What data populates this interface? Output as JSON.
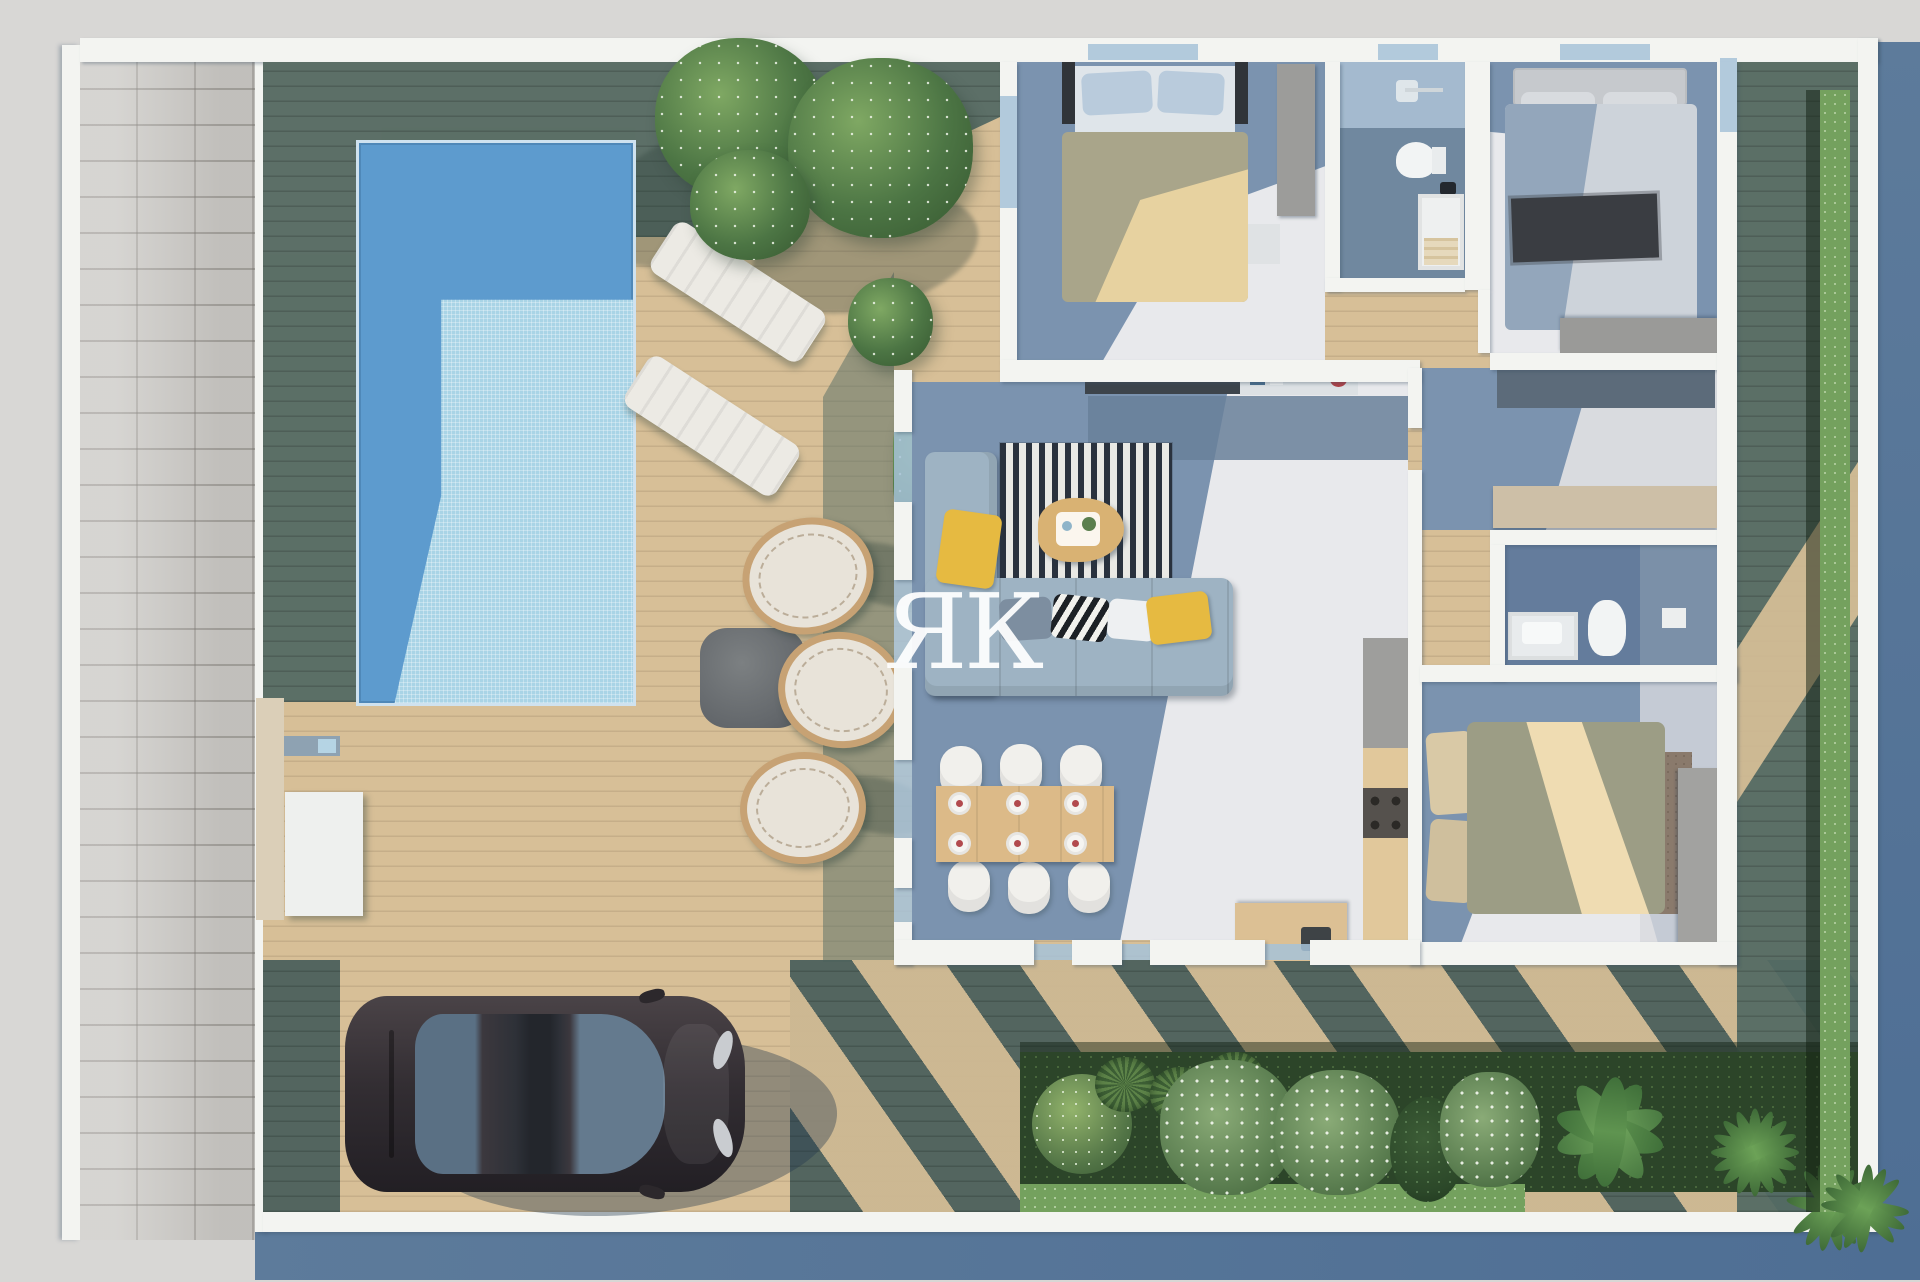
{
  "watermark": {
    "text": "ЯК"
  },
  "scene": {
    "type": "3d-architectural-floor-plan-render",
    "view": "top-down aerial",
    "areas": [
      {
        "name": "stone-path",
        "items": [
          "paver-bricks"
        ]
      },
      {
        "name": "pool-terrace",
        "items": [
          "swimming-pool",
          "sun-lounger-1",
          "sun-lounger-2",
          "egg-chair-1",
          "egg-chair-2",
          "egg-chair-3",
          "outdoor-coffee-table",
          "tree-1",
          "tree-2",
          "bush",
          "potted-plant"
        ]
      },
      {
        "name": "driveway",
        "items": [
          "sedan-car"
        ]
      },
      {
        "name": "living-room",
        "items": [
          "corner-sofa",
          "striped-rug",
          "coffee-table",
          "tv-console",
          "sideboard",
          "yellow-pillows",
          "chevron-pillows"
        ]
      },
      {
        "name": "dining-area",
        "items": [
          "dining-table",
          "dining-chairs-x6",
          "place-settings",
          "plant"
        ]
      },
      {
        "name": "kitchen",
        "items": [
          "counter",
          "cooktop",
          "island-with-sink"
        ]
      },
      {
        "name": "bedroom-1",
        "items": [
          "double-bed-gold-duvet",
          "blue-pillows",
          "wardrobe",
          "nightstand"
        ]
      },
      {
        "name": "bathroom-1",
        "items": [
          "shower",
          "toilet",
          "vanity",
          "towels"
        ]
      },
      {
        "name": "bedroom-2",
        "items": [
          "double-bed-gray-duvet",
          "dark-throw",
          "headboard",
          "dresser"
        ]
      },
      {
        "name": "hallway",
        "items": [
          "runner-rug",
          "sideboard"
        ]
      },
      {
        "name": "bathroom-2",
        "items": [
          "vanity",
          "toilet",
          "shower-area"
        ]
      },
      {
        "name": "bedroom-3",
        "items": [
          "double-bed-beige-duvet",
          "pillows",
          "brown-rug",
          "wardrobe"
        ]
      },
      {
        "name": "garden-bed",
        "items": [
          "dark-hedge",
          "boxwood-ball",
          "ornamental-grasses",
          "flowering-shrub-1",
          "flowering-shrub-2",
          "conifer",
          "flowering-shrub-3",
          "banana-plant",
          "palm-1",
          "palm-2",
          "corner-palm",
          "low-hedge",
          "side-hedge"
        ]
      }
    ]
  },
  "colors": {
    "bg": "#d8d7d5",
    "shadow-blue": "#5d7b9b",
    "shadow-blue2": "#4e6e94",
    "wall": "#f3f4f1",
    "path": "#c9c7c3",
    "path-line": "#aeaaa5",
    "deck-light": "#d7bf97",
    "deck-dark": "#546b64",
    "deck-dark2": "#4b605c",
    "pool-water": "#5d9bce",
    "pool-shallow": "#a9d4e6",
    "marble-light": "#e8e9ec",
    "marble-shadow": "#7b93af",
    "sofa": "#9eb3c3",
    "accent-yellow": "#e6ba41",
    "rug-dark": "#2a323e",
    "rug-light": "#e9e9e5",
    "duvet-gold": "#e7d2a0",
    "duvet-gold-sh": "#a9a58a",
    "duvet-beige": "#efdcb2",
    "duvet-olive": "#9c9d85",
    "wood": "#dcba88",
    "counter-gray": "#9e9e9c",
    "counter-wood": "#e1c89b",
    "cooktop": "#55514d",
    "hedge-dark": "#2c4529",
    "hedge-light": "#74a15e",
    "tree-light": "#7fa863",
    "tree-mid": "#4c7544",
    "tree-dark": "#35562f",
    "rattan": "#c7a274",
    "cushion": "#e8e3d9",
    "car-body": "#413a40",
    "car-glass": "#6c8196",
    "glass": "#a6c2d8"
  }
}
